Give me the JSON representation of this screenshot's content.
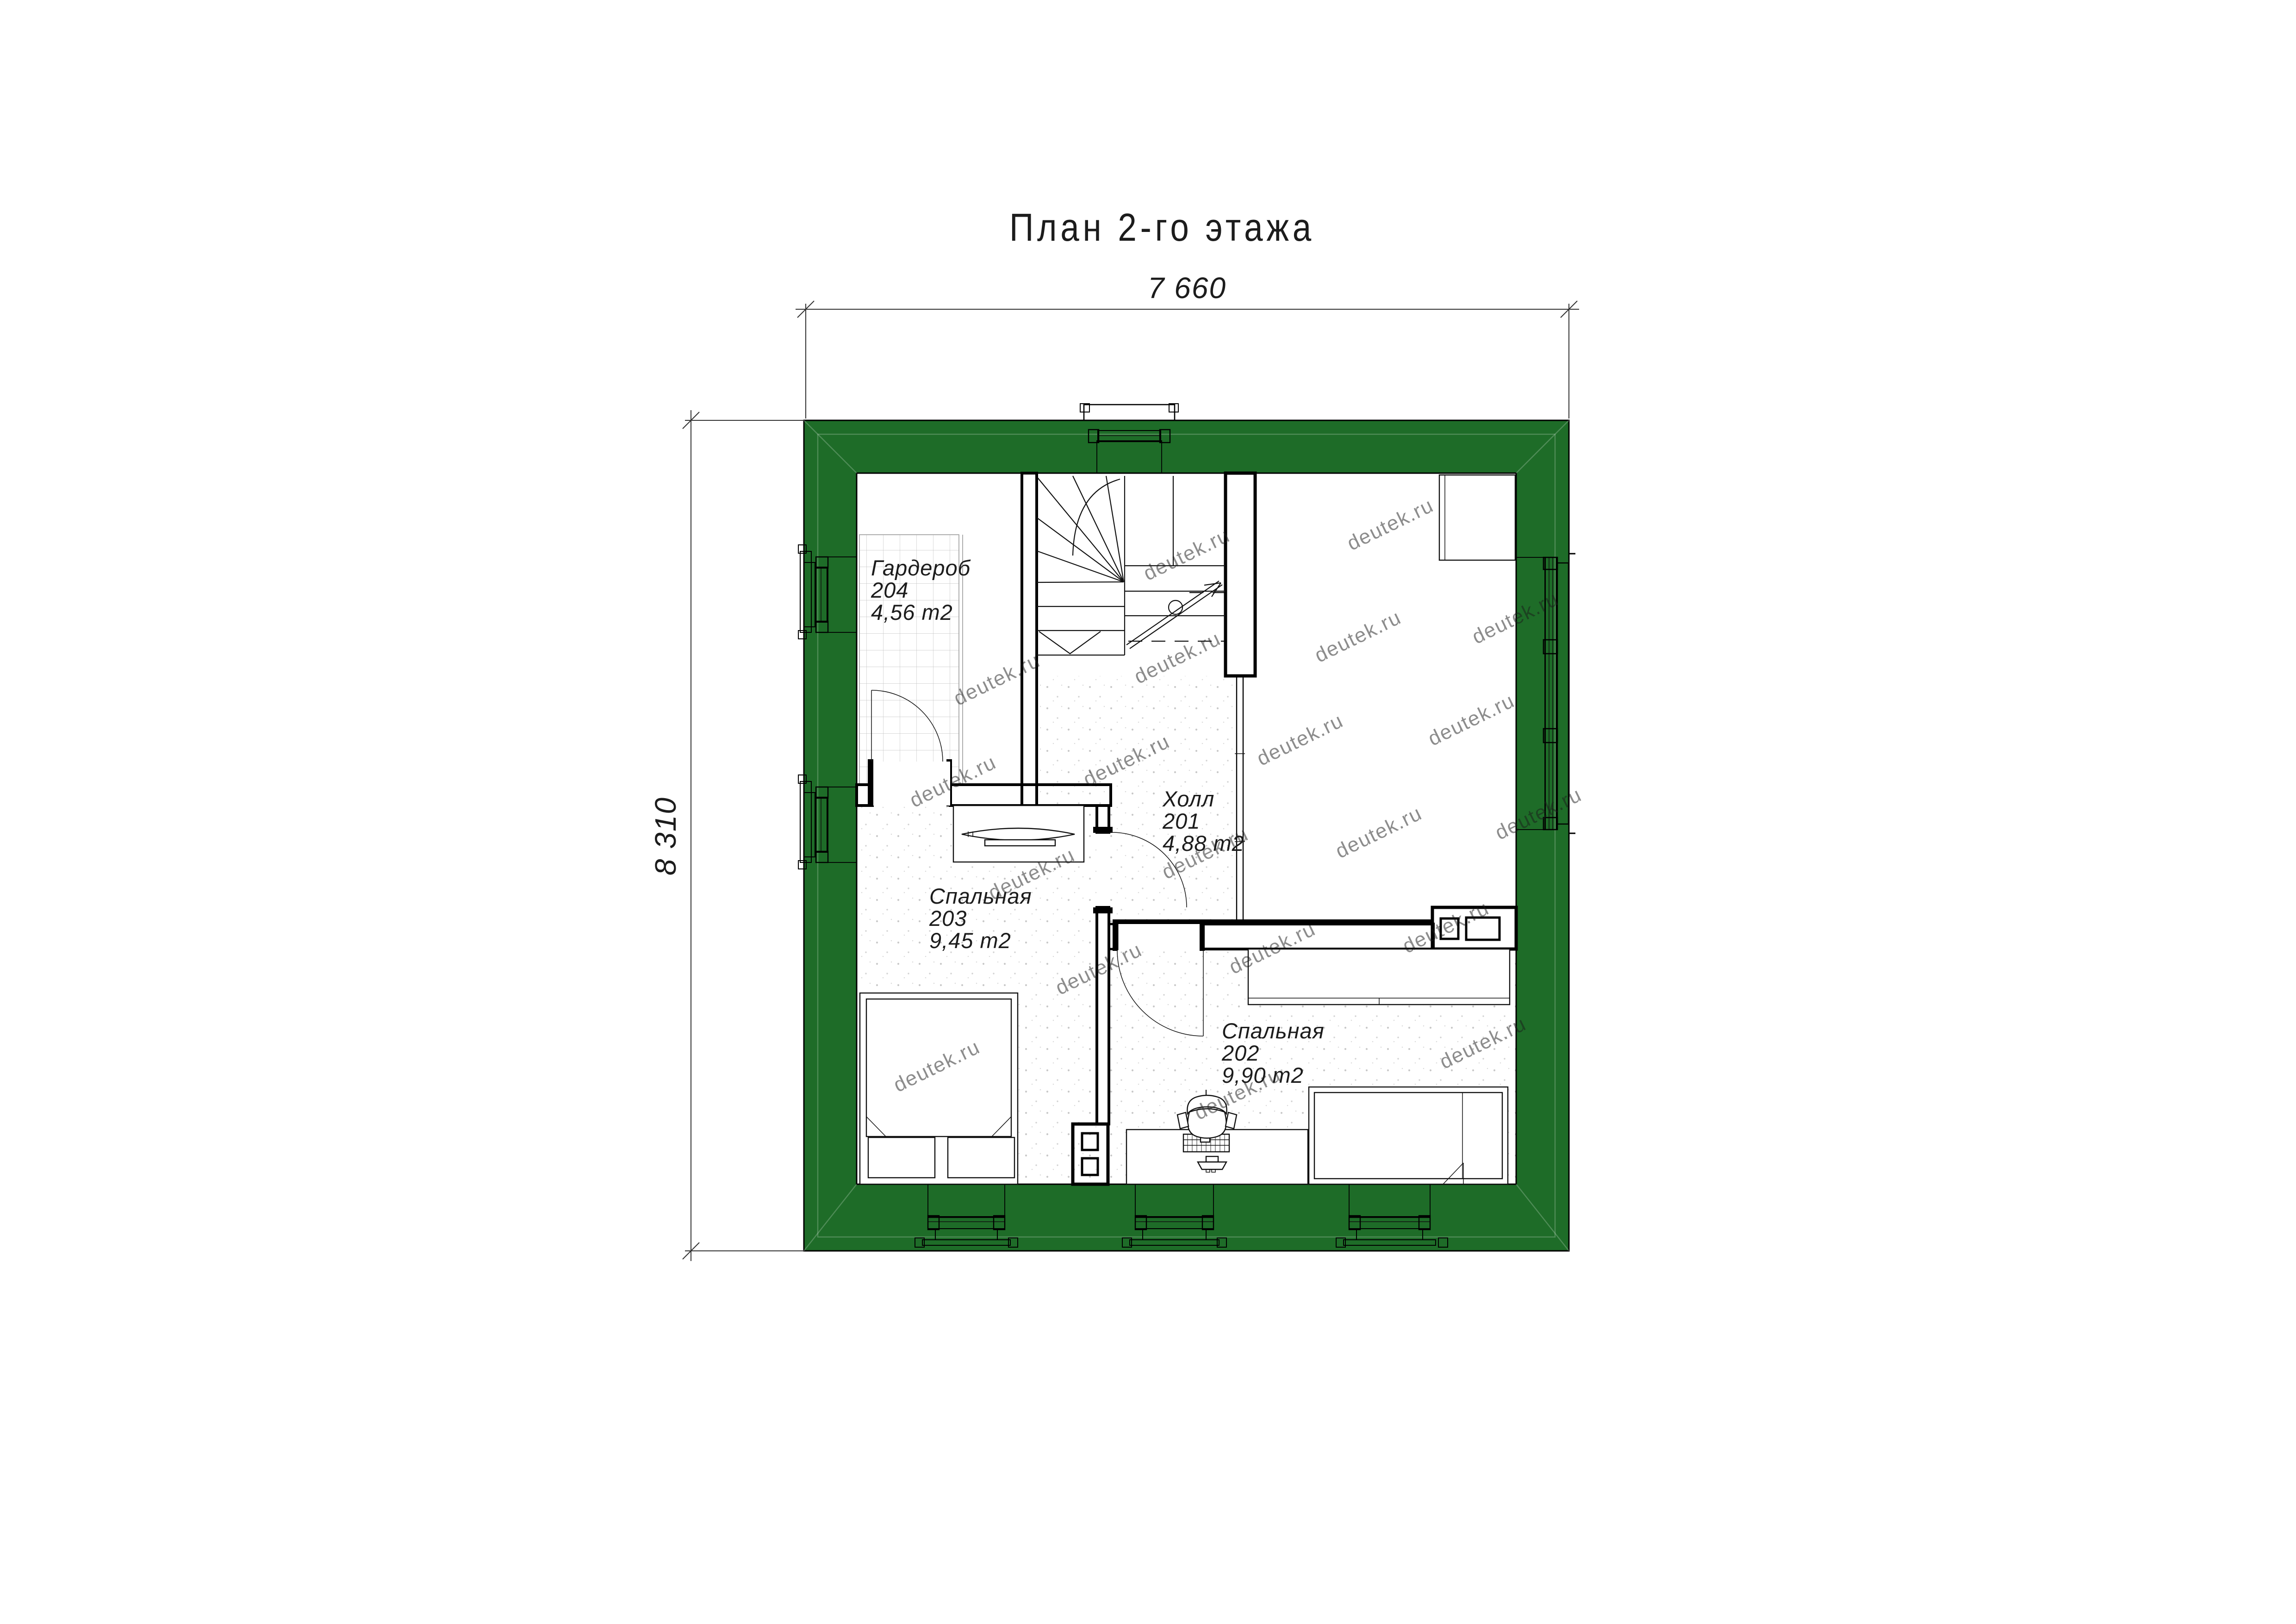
{
  "title": "План 2-го этажа",
  "dimensions": {
    "top": "7 660",
    "left": "8 310"
  },
  "rooms": [
    {
      "id": "hall",
      "name": "Холл",
      "number": "201",
      "area": "4,88 m2"
    },
    {
      "id": "bedroom-202",
      "name": "Спальная",
      "number": "202",
      "area": "9,90 m2"
    },
    {
      "id": "bedroom-203",
      "name": "Спальная",
      "number": "203",
      "area": "9,45 m2"
    },
    {
      "id": "wardrobe-204",
      "name": "Гардероб",
      "number": "204",
      "area": "4,56 m2"
    }
  ],
  "watermark": {
    "text": "deutek.ru"
  },
  "colors": {
    "wall_green": "#1e6c28",
    "outline_black": "#000000",
    "dim_line": "#333333",
    "label_text": "#1c1c1c",
    "watermark_gray": "#bdbdbd",
    "floor_speckle": "#c9c9c9",
    "tile_line": "#bfbfbf"
  }
}
